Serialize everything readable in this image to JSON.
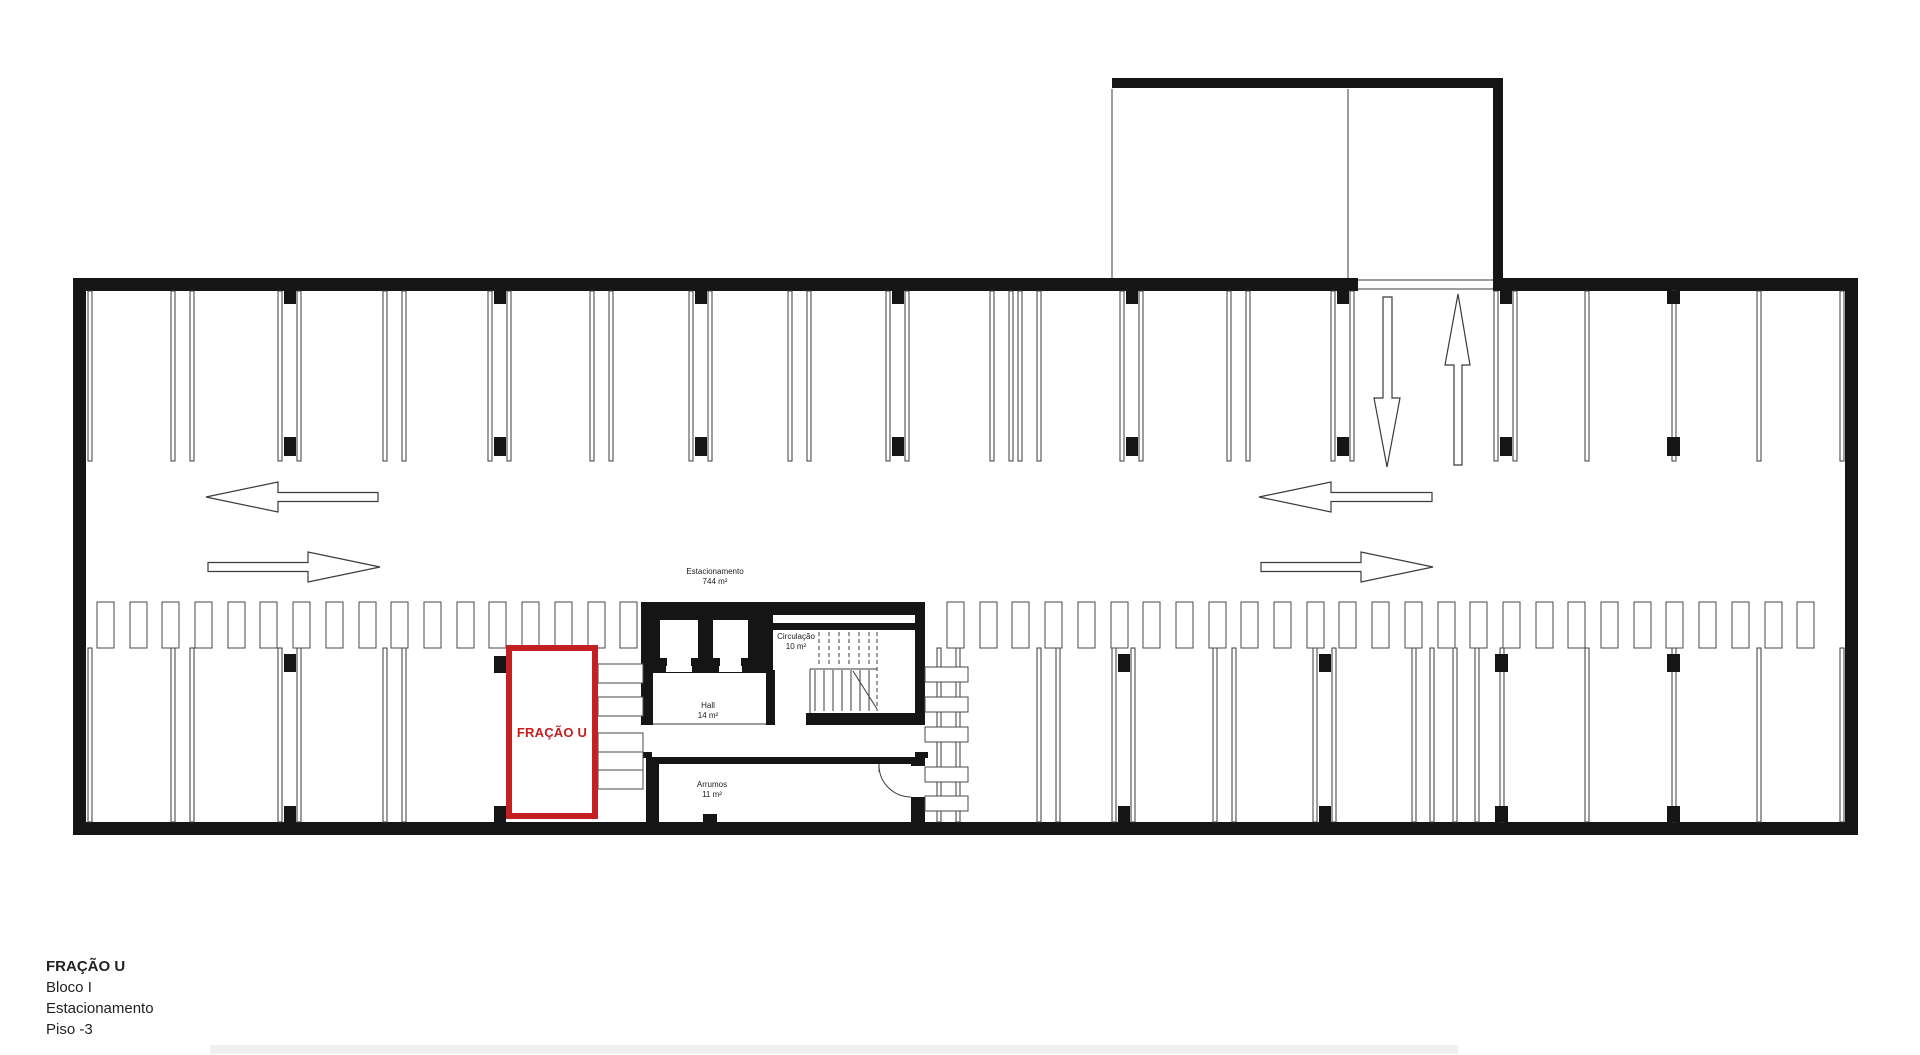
{
  "title_block": {
    "title": "FRAÇÃO U",
    "block": "Bloco I",
    "use": "Estacionamento",
    "floor": "Piso -3"
  },
  "rooms": {
    "estacionamento": {
      "name": "Estacionamento",
      "area": "744 m²"
    },
    "circulacao": {
      "name": "Circulação",
      "area": "10 m²"
    },
    "hall": {
      "name": "Hall",
      "area": "14 m²"
    },
    "arrumos": {
      "name": "Arrumos",
      "area": "11 m²"
    }
  },
  "highlight": {
    "label": "FRAÇÃO U",
    "color": "#c3201f"
  },
  "colors": {
    "wall": "#151515",
    "line": "#3b3b3b",
    "comb": "#4a4a4a",
    "bar": "#efefef"
  },
  "plan": {
    "width": 1920,
    "height": 1055,
    "walls": [
      [
        73,
        278,
        13,
        557
      ],
      [
        1845,
        278,
        13,
        557
      ],
      [
        73,
        822,
        1785,
        13
      ],
      [
        73,
        278,
        1285,
        13
      ],
      [
        1493,
        278,
        365,
        13
      ],
      [
        1112,
        78,
        391,
        10
      ],
      [
        1493,
        88,
        10,
        190
      ],
      [
        641,
        602,
        284,
        13
      ],
      [
        641,
        615,
        12,
        110
      ],
      [
        653,
        615,
        120,
        58
      ],
      [
        915,
        615,
        10,
        110
      ],
      [
        773,
        623,
        142,
        7
      ],
      [
        766,
        670,
        9,
        55
      ],
      [
        806,
        713,
        119,
        12
      ],
      [
        641,
        752,
        11,
        6
      ],
      [
        915,
        752,
        13,
        6
      ],
      [
        646,
        757,
        279,
        7
      ],
      [
        646,
        764,
        13,
        58
      ],
      [
        911,
        757,
        14,
        9
      ],
      [
        911,
        797,
        14,
        25
      ],
      [
        703,
        814,
        14,
        8
      ]
    ],
    "whites": [
      [
        660,
        620,
        38,
        46
      ],
      [
        713,
        620,
        35,
        46
      ],
      [
        666,
        666,
        26,
        6
      ],
      [
        719,
        666,
        23,
        6
      ]
    ],
    "notches": [
      [
        660,
        658,
        7,
        8
      ],
      [
        691,
        658,
        7,
        8
      ],
      [
        713,
        658,
        7,
        8
      ],
      [
        741,
        658,
        7,
        8
      ]
    ],
    "thin_lines": [
      [
        1112,
        89,
        1112,
        278
      ],
      [
        1348,
        89,
        1348,
        278
      ],
      [
        1358,
        280,
        1493,
        280
      ],
      [
        1358,
        289,
        1493,
        289
      ],
      [
        653,
        724,
        766,
        724
      ],
      [
        810,
        669,
        877,
        669
      ],
      [
        810,
        669,
        810,
        713
      ],
      [
        853,
        671,
        877,
        709
      ]
    ],
    "stairs": {
      "solid_x": [
        815,
        824,
        833,
        842,
        851,
        860,
        869
      ],
      "solid_y1": 670,
      "solid_y2": 711,
      "dash_x": [
        819,
        829,
        839,
        849,
        859,
        869
      ],
      "dash_y1": 632,
      "dash_y2": 666,
      "long_dash": [
        877,
        632,
        877,
        711
      ]
    },
    "door": {
      "leaf": [
        879,
        764,
        879,
        772
      ],
      "arc": "M 879 765 A 32 32 0 0 0 911 797"
    },
    "top_strip": {
      "y1": 291,
      "y2": 461,
      "pairs": [
        {
          "x": 171
        },
        {
          "x": 278,
          "c": 1
        },
        {
          "x": 383
        },
        {
          "x": 488,
          "c": 1
        },
        {
          "x": 590
        },
        {
          "x": 689,
          "c": 1
        },
        {
          "x": 788
        },
        {
          "x": 886,
          "c": 1
        },
        {
          "x": 990
        },
        {
          "x": 1018
        },
        {
          "x": 1120,
          "c": 1
        },
        {
          "x": 1227
        },
        {
          "x": 1331,
          "c": 1
        },
        {
          "x": 1494,
          "c": 1
        }
      ],
      "singles": [
        88,
        1585,
        1757,
        1840
      ],
      "singles_c": [
        1672
      ],
      "col_top_y": 291,
      "col_top_h": 13,
      "col_bot_y": 437,
      "col_bot_h": 19
    },
    "bottom_strip": {
      "y1": 648,
      "y2": 822,
      "pairs": [
        {
          "x": 171
        },
        {
          "x": 278,
          "c": 1
        },
        {
          "x": 383
        },
        {
          "x": 937
        },
        {
          "x": 1037
        },
        {
          "x": 1112,
          "c": 1
        },
        {
          "x": 1213
        },
        {
          "x": 1313,
          "c": 1
        }
      ],
      "singles": [
        88,
        1412,
        1430,
        1453,
        1475,
        1585,
        1757,
        1840
      ],
      "singles_c": [
        1500,
        1672
      ],
      "col_top_y": 654,
      "col_top_h": 18,
      "col_bot_y": 806,
      "col_bot_h": 16
    },
    "columns_extra": [
      [
        494,
        656,
        12,
        17
      ],
      [
        494,
        806,
        12,
        16
      ]
    ],
    "combs": {
      "y": 602,
      "h": 46,
      "w": 17,
      "step": 32.7,
      "runs": [
        [
          97,
          640
        ],
        [
          947,
          1820
        ]
      ]
    },
    "storage_left": {
      "x": 598,
      "w": 45,
      "h": 19,
      "ys": [
        664,
        697,
        733,
        752,
        770
      ]
    },
    "storage_right": {
      "x": 925,
      "w": 43,
      "h": 15,
      "ys": [
        667,
        697,
        727,
        767,
        796
      ]
    },
    "arrows_h": [
      {
        "tip": 206,
        "back": 378,
        "y": 497,
        "dir": "left"
      },
      {
        "tip": 380,
        "back": 208,
        "y": 567,
        "dir": "right"
      },
      {
        "tip": 1259,
        "back": 1432,
        "y": 497,
        "dir": "left"
      },
      {
        "tip": 1433,
        "back": 1261,
        "y": 567,
        "dir": "right"
      }
    ],
    "head_len": 72,
    "head_half": 15,
    "shaft_half": 4.5,
    "arrow_down": "1383,297 1392,297 1392,398 1400,398 1387,467 1374,398 1383,398",
    "arrow_up": "1454,465 1454,365 1445,365 1458,294 1470,365 1462,365 1462,465"
  }
}
